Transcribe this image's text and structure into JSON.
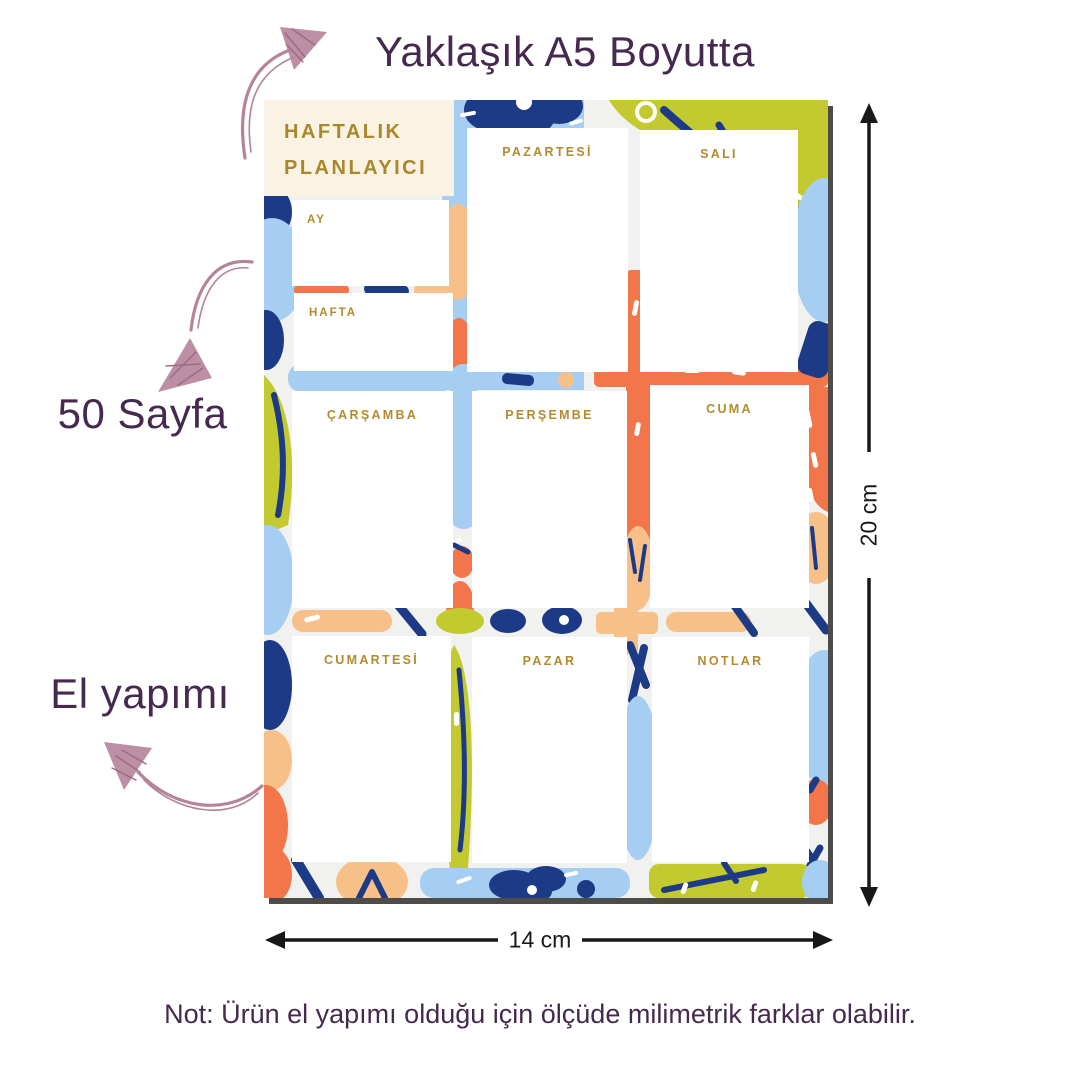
{
  "captions": {
    "size": "Yaklaşık A5 Boyutta",
    "pages": "50 Sayfa",
    "handmade": "El yapımı",
    "note": "Not: Ürün el yapımı olduğu için ölçüde milimetrik farklar olabilir.",
    "text_color": "#46294e",
    "arrow_color": "#b5839a"
  },
  "dimensions": {
    "height": "20 cm",
    "width": "14 cm",
    "line_color": "#181818"
  },
  "planner": {
    "title_line1": "HAFTALIK",
    "title_line2": "PLANLAYICI",
    "title_color": "#a9882b",
    "header_bg": "#faf3e3",
    "label_color": "#b28b2e",
    "fields": {
      "month": "AY",
      "week": "HAFTA"
    },
    "days": {
      "monday": "PAZARTESİ",
      "tuesday": "SALI",
      "wednesday": "ÇARŞAMBA",
      "thursday": "PERŞEMBE",
      "friday": "CUMA",
      "saturday": "CUMARTESİ",
      "sunday": "PAZAR"
    },
    "notes_label": "NOTLAR",
    "pattern_colors": {
      "background": "#f1f1ef",
      "navy": "#1c3a85",
      "light_blue": "#a6cdf2",
      "orange": "#f2764a",
      "peach": "#f8c089",
      "lime": "#c3ca2f",
      "shadow": "#4e4c48"
    }
  }
}
